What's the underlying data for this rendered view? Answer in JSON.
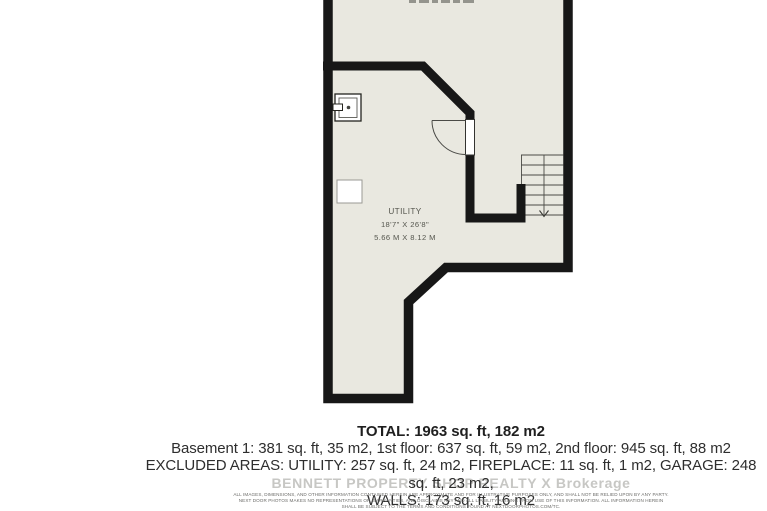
{
  "floorplan": {
    "room_label": "UTILITY",
    "room_dimensions_imperial": "18'7\" X 26'8\"",
    "room_dimensions_metric": "5.66 M X 8.12 M",
    "stairs_direction": "down"
  },
  "summary": {
    "total_line": "TOTAL: 1963 sq. ft, 182 m2",
    "floors_line": "Basement 1: 381 sq. ft, 35 m2, 1st floor: 637 sq. ft, 59 m2, 2nd floor: 945 sq. ft, 88 m2",
    "excluded_line": "EXCLUDED AREAS: UTILITY: 257 sq. ft, 24 m2, FIREPLACE: 11 sq. ft, 1 m2, GARAGE: 248 sq. ft, 23 m2,",
    "walls_line": "WALLS: 173 sq. ft, 16 m2"
  },
  "watermark": "BENNETT PROPERTY SHOP REALTY X Brokerage",
  "disclaimer": {
    "line1": "ALL IMAGES, DIMENSIONS, AND OTHER INFORMATION CONTAINED HEREIN ARE APPROXIMATE AND FOR ILLUSTRATIVE PURPOSES ONLY, AND SHALL NOT BE RELIED UPON BY ANY PARTY.",
    "line2": "NEXT DOOR PHOTOS MAKES NO REPRESENTATIONS OR WARRANTIES, AND DISCLAIMS ANY AND ALL LIABILITY ARISING FROM USE OF THIS INFORMATION. ALL INFORMATION HEREIN",
    "line3": "SHALL BE SUBJECT TO THE TERMS AND CONDITIONS FOUND AT NEXTDOORPHOTOS.COM/TC."
  },
  "colors": {
    "floor_fill": "#e9e8e0",
    "wall": "#171717",
    "plan_text": "#55564e",
    "summary_text": "#2e2e2e",
    "watermark_text": "#c7c7c4",
    "disclaimer_text": "#6b6b68"
  }
}
